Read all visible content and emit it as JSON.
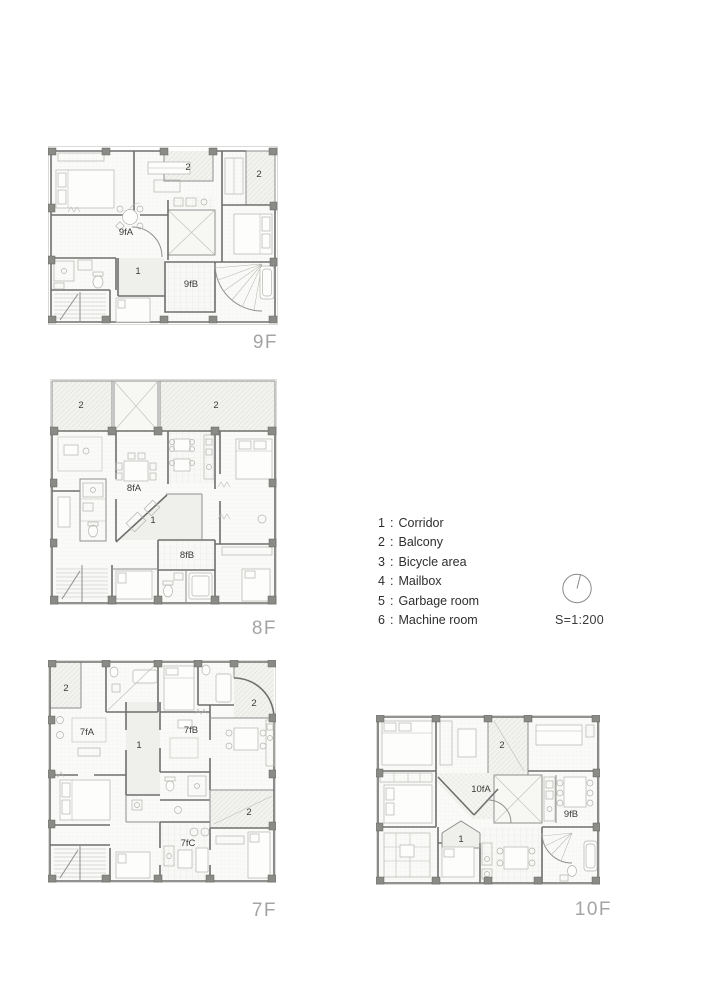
{
  "plans": {
    "f9": {
      "floor_label": "9F",
      "unit_a": "9fA",
      "unit_b": "9fB",
      "corridor_num": "1",
      "balcony_num": "2"
    },
    "f8": {
      "floor_label": "8F",
      "unit_a": "8fA",
      "unit_b": "8fB",
      "corridor_num": "1",
      "balcony_num": "2"
    },
    "f7": {
      "floor_label": "7F",
      "unit_a": "7fA",
      "unit_b": "7fB",
      "unit_c": "7fC",
      "corridor_num": "1",
      "balcony_num": "2"
    },
    "f10": {
      "floor_label": "10F",
      "unit_a": "10fA",
      "unit_b": "9fB",
      "corridor_num": "1",
      "balcony_num": "2"
    }
  },
  "legend": {
    "separator": ":",
    "items": [
      {
        "num": "1",
        "label": "Corridor"
      },
      {
        "num": "2",
        "label": "Balcony"
      },
      {
        "num": "3",
        "label": "Bicycle area"
      },
      {
        "num": "4",
        "label": "Mailbox"
      },
      {
        "num": "5",
        "label": "Garbage room"
      },
      {
        "num": "6",
        "label": "Machine room"
      }
    ]
  },
  "scale_label": "S=1:200",
  "north_indicator": {
    "icon": "north-circle"
  },
  "colors": {
    "wall": "#6f6f6f",
    "partition": "#8f8f8f",
    "column": "#8a8a86",
    "floor_label_text": "#a4a4a4",
    "legend_text": "#2e2e2e",
    "balcony_hatch": "#e2e2de",
    "paper": "#ffffff"
  }
}
